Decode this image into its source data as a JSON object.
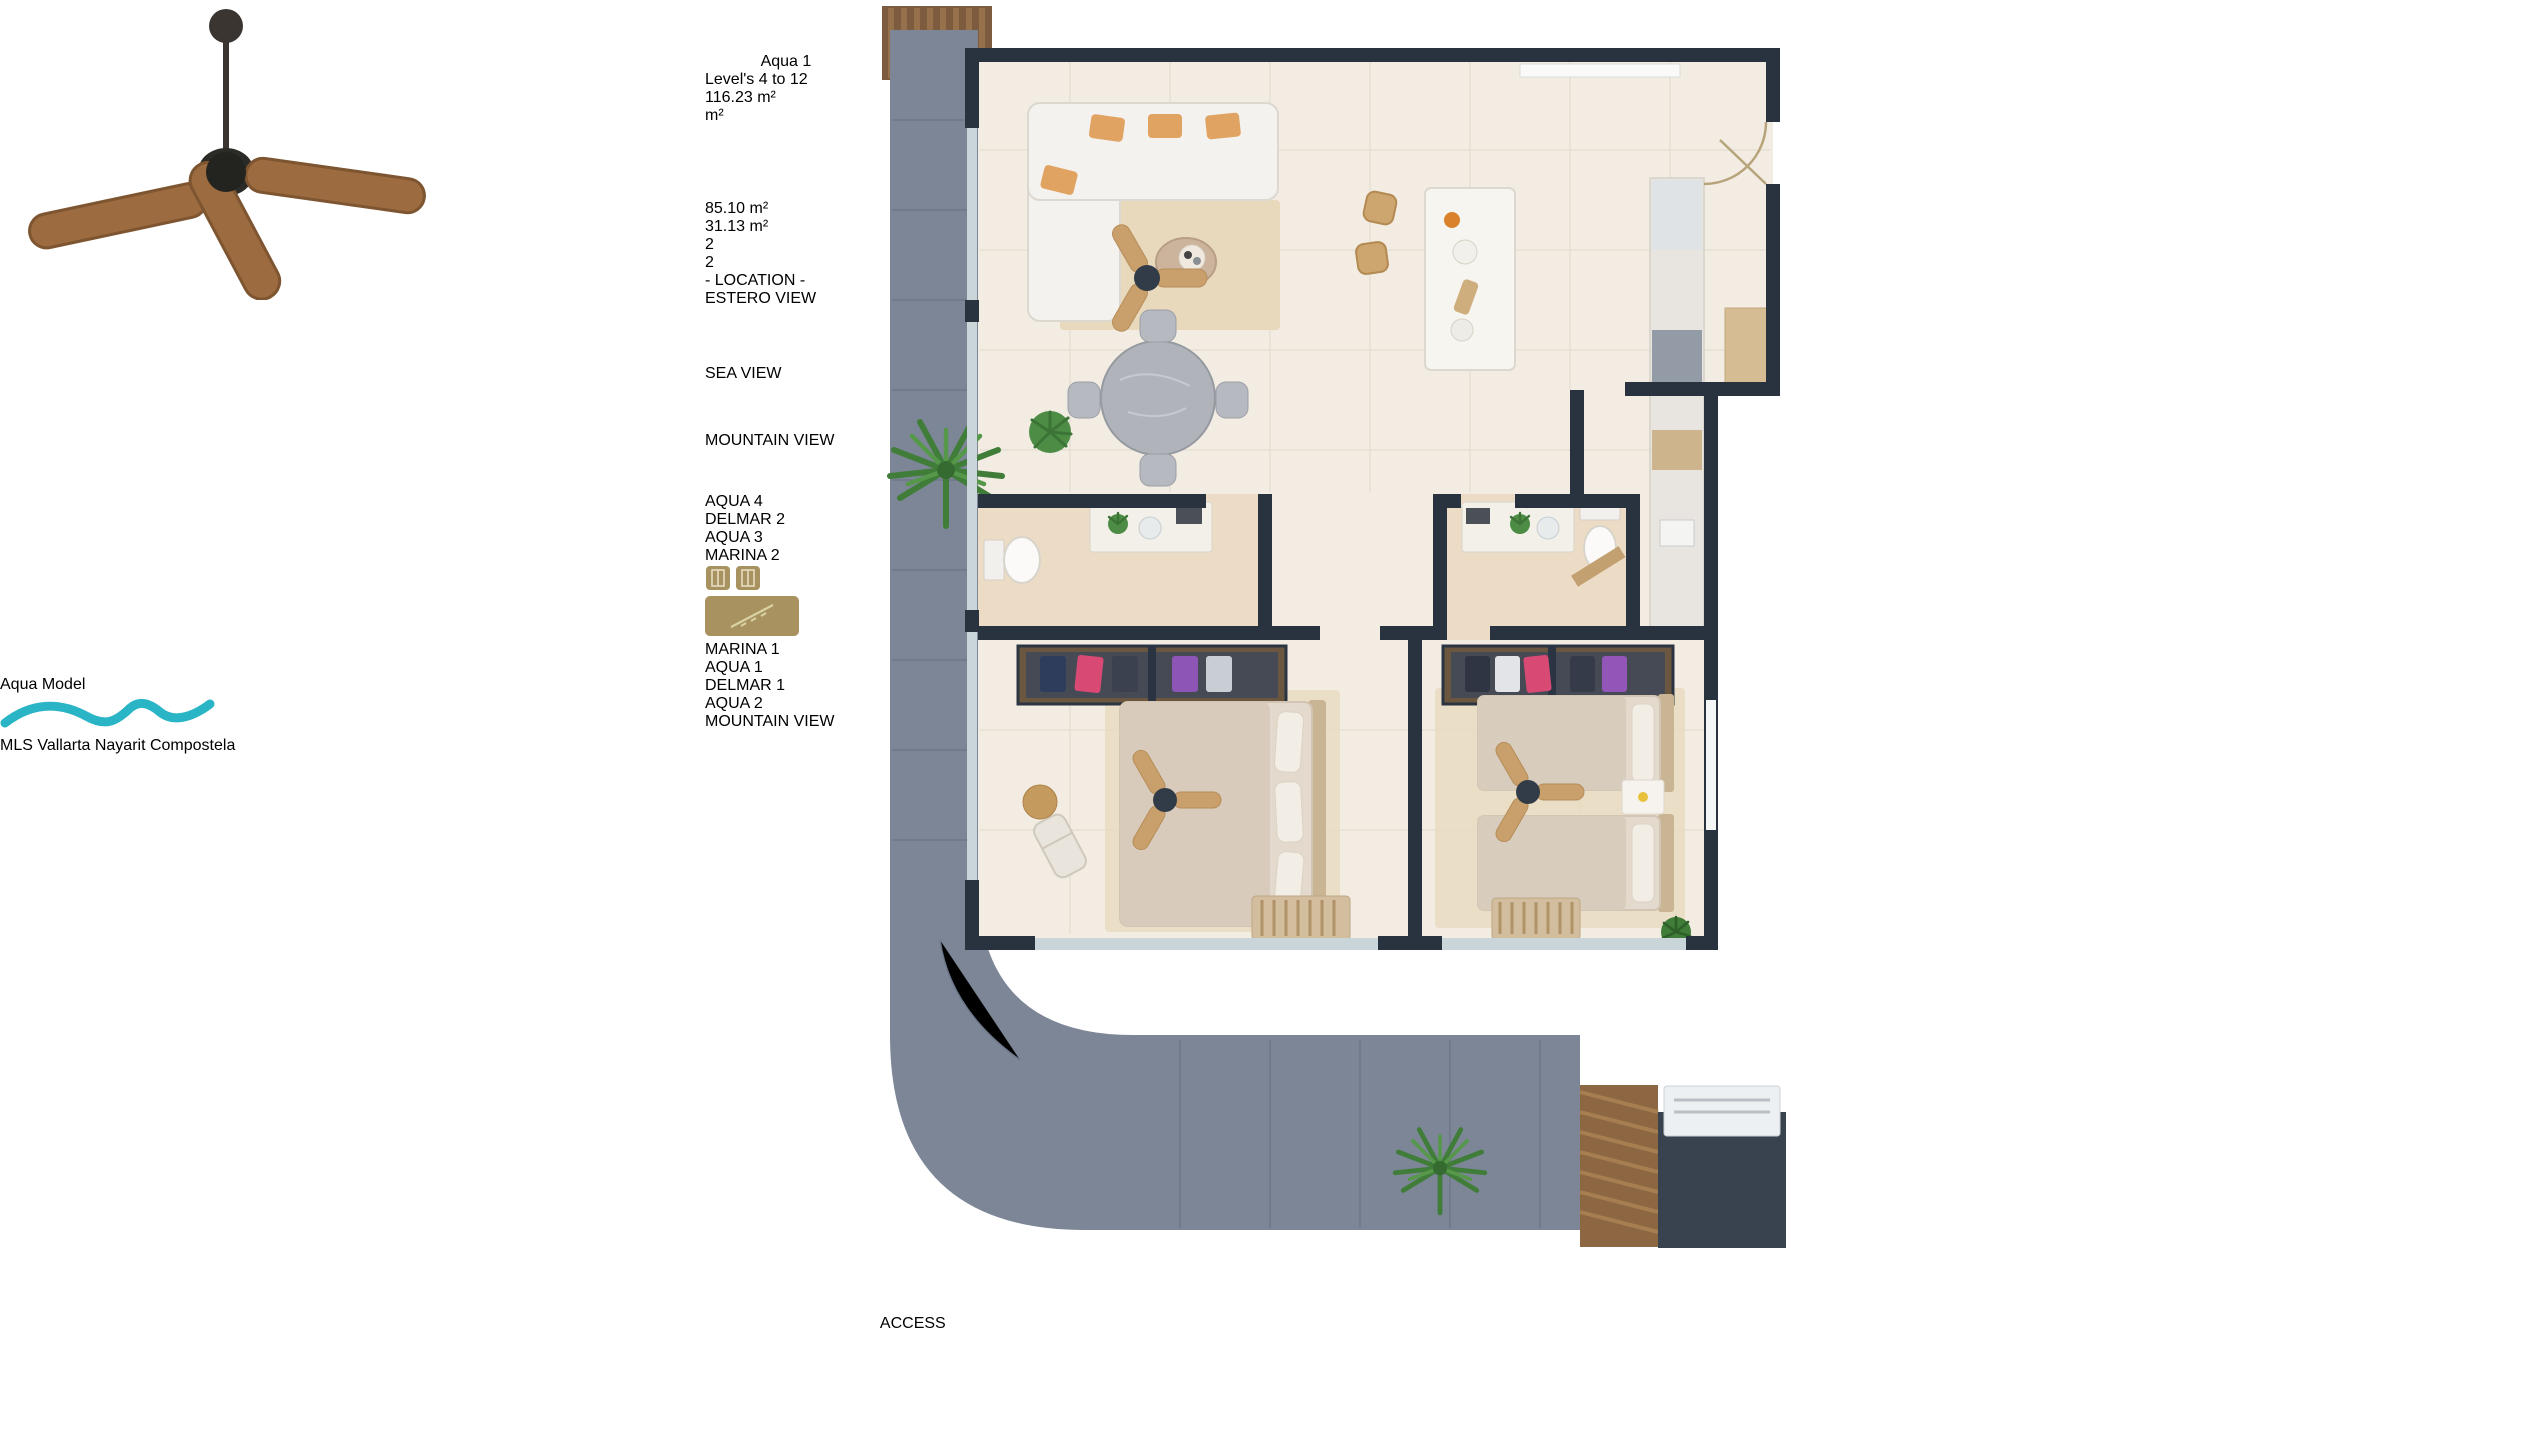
{
  "palette": {
    "teal": "#12a0af",
    "teal-wave": "#2ab5c6",
    "gold": "#a8925f",
    "gold-border": "#d9d2a4",
    "navy": "#0d2335",
    "tan": "#dcc79e",
    "tan-text": "#8d7f5e",
    "aqua-light": "#9cdbe1",
    "wall": "#29323f",
    "balcony": "#7d8697"
  },
  "photo_panel": {
    "title": "Aqua Model",
    "watermark": "MLS Vallarta Nayarit Compostela"
  },
  "info_panel": {
    "unit_name": "Aqua 1",
    "levels": "Level's 4 to 12",
    "total_area": "116.23 m²",
    "specs": {
      "header_area": "m²",
      "interior_area": "85.10 m²",
      "terrace_area": "31.13 m²",
      "bedrooms": "2",
      "bathrooms": "2"
    },
    "location": {
      "heading": "- LOCATION -",
      "estero_view": "ESTERO VIEW",
      "sea_view": "SEA VIEW",
      "mountain_view_right": "MOUNTAIN VIEW",
      "mountain_view_bottom": "MOUNTAIN VIEW",
      "grid": {
        "cells": [
          {
            "line1": "AQUA",
            "line2": "4"
          },
          {
            "line1": "DELMAR",
            "line2": "2"
          },
          {
            "line1": "AQUA",
            "line2": "3"
          },
          {
            "line1": "MARINA",
            "line2": "2"
          },
          {
            "line1": "MARINA",
            "line2": "1"
          },
          {
            "line1": "AQUA",
            "line2": "1"
          },
          {
            "line1": "DELMAR",
            "line2": "1"
          },
          {
            "line1": "AQUA",
            "line2": "2"
          }
        ]
      }
    }
  },
  "floor_plan": {
    "access_label": "ACCESS"
  }
}
